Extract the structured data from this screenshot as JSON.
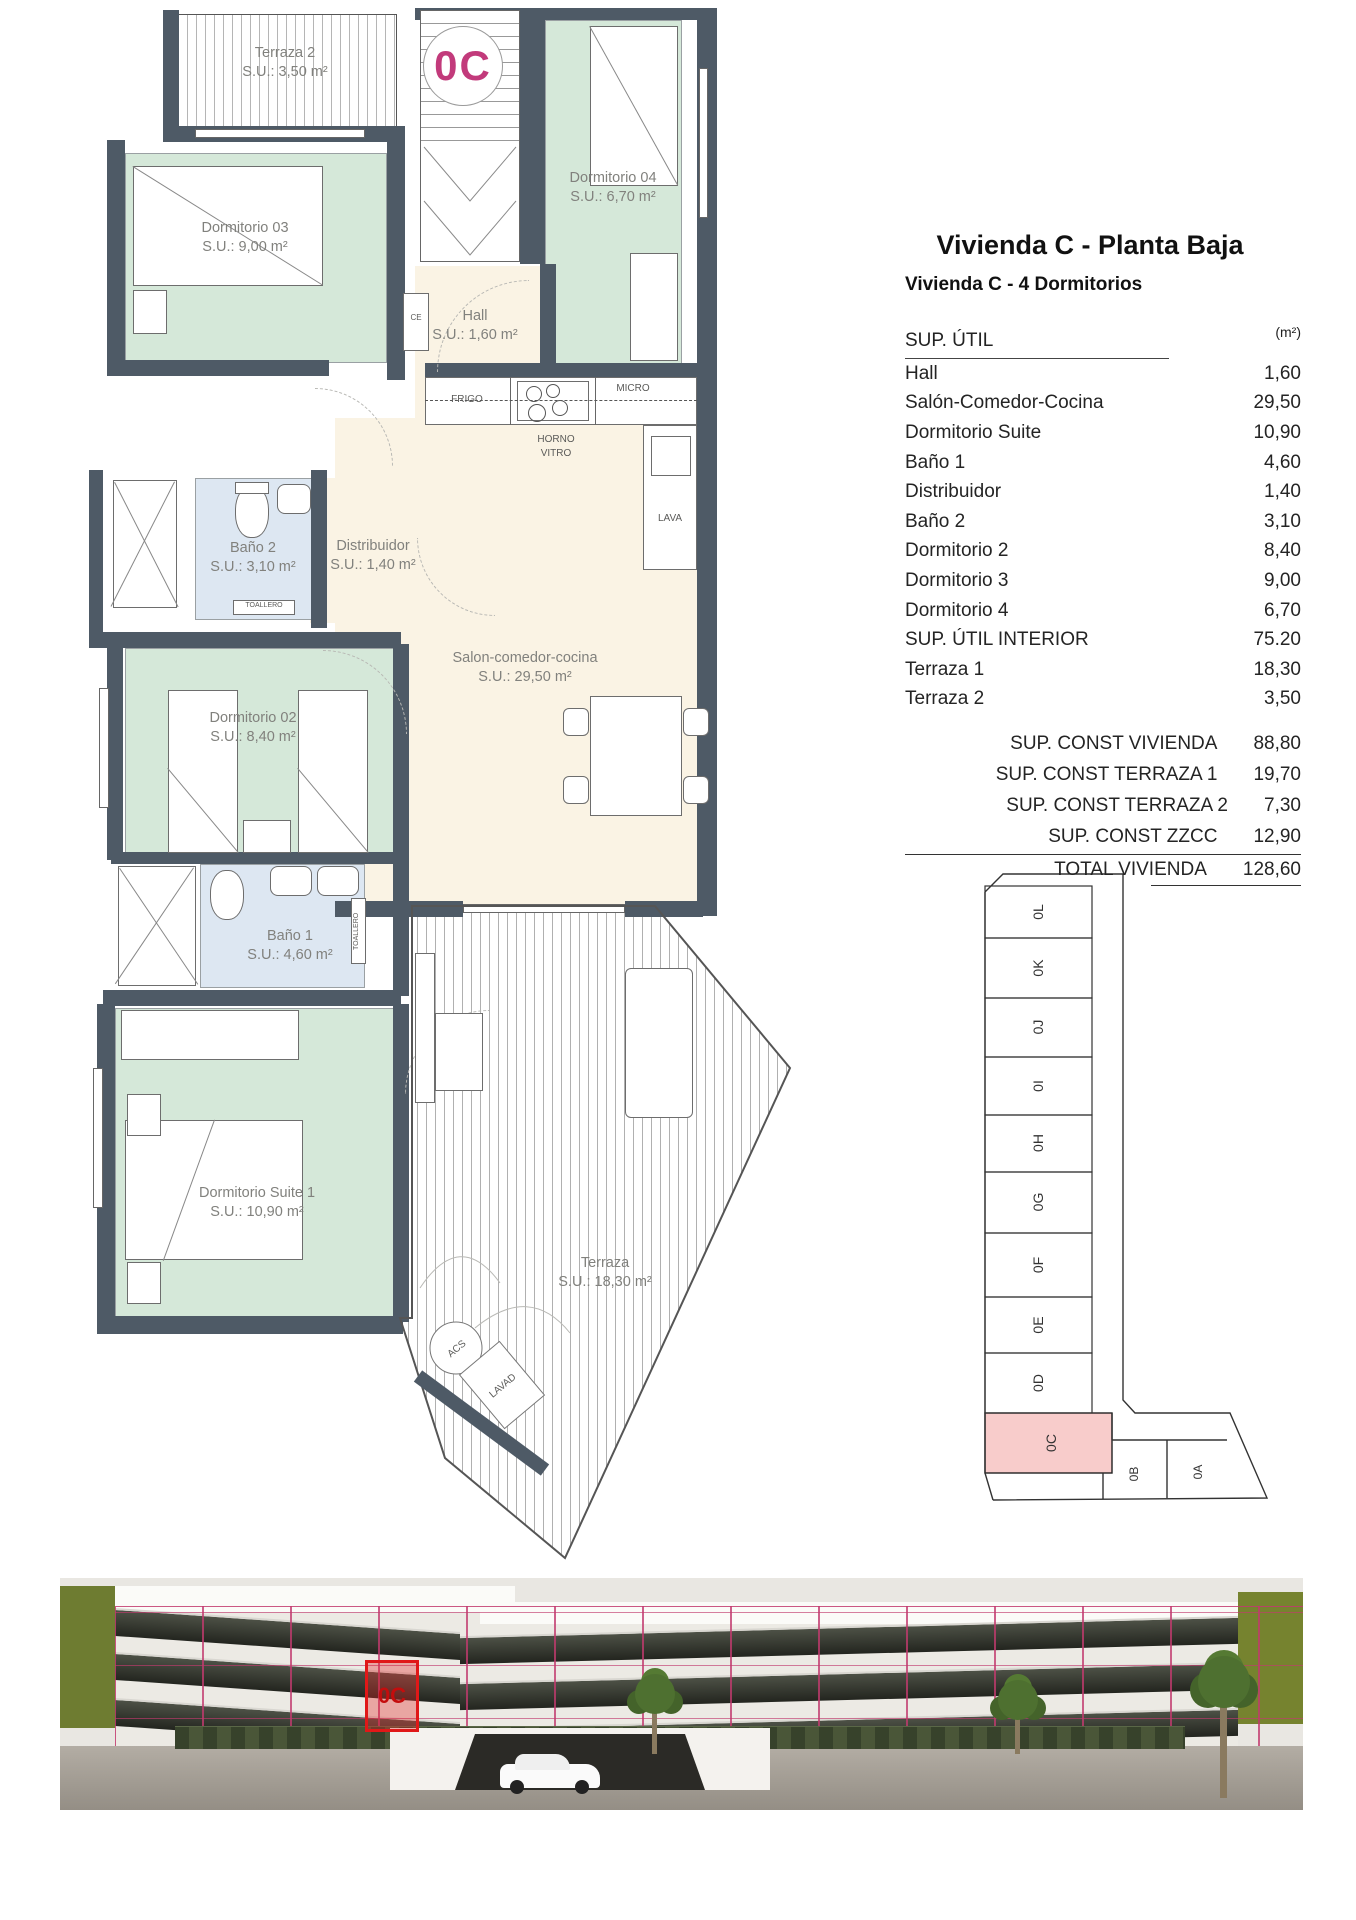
{
  "header": {
    "title": "Vivienda C - Planta Baja",
    "subtitle": "Vivienda C - 4 Dormitorios"
  },
  "area_table": {
    "title": "SUP. ÚTIL",
    "unit": "(m²)",
    "rows": [
      {
        "label": "Hall",
        "value": "1,60"
      },
      {
        "label": "Salón-Comedor-Cocina",
        "value": "29,50"
      },
      {
        "label": "Dormitorio Suite",
        "value": "10,90"
      },
      {
        "label": "Baño 1",
        "value": "4,60"
      },
      {
        "label": "Distribuidor",
        "value": "1,40"
      },
      {
        "label": "Baño 2",
        "value": "3,10"
      },
      {
        "label": "Dormitorio 2",
        "value": "8,40"
      },
      {
        "label": "Dormitorio 3",
        "value": "9,00"
      },
      {
        "label": "Dormitorio 4",
        "value": "6,70"
      },
      {
        "label": "SUP. ÚTIL INTERIOR",
        "value": "75.20"
      },
      {
        "label": "Terraza 1",
        "value": "18,30"
      },
      {
        "label": "Terraza 2",
        "value": "3,50"
      }
    ],
    "summary": [
      {
        "label": "SUP. CONST VIVIENDA",
        "value": "88,80"
      },
      {
        "label": "SUP. CONST TERRAZA 1",
        "value": "19,70"
      },
      {
        "label": "SUP. CONST TERRAZA 2",
        "value": "7,30"
      },
      {
        "label": "SUP. CONST ZZCC",
        "value": "12,90"
      }
    ],
    "total": {
      "label": "TOTAL VIVIENDA",
      "value": "128,60"
    }
  },
  "plan": {
    "badge": "0C",
    "rooms": {
      "terraza2": {
        "name": "Terraza 2",
        "area": "S.U.: 3,50 m²"
      },
      "dorm3": {
        "name": "Dormitorio 03",
        "area": "S.U.: 9,00 m²"
      },
      "dorm4": {
        "name": "Dormitorio 04",
        "area": "S.U.: 6,70 m²"
      },
      "hall": {
        "name": "Hall",
        "area": "S.U.: 1,60 m²"
      },
      "bano2": {
        "name": "Baño 2",
        "area": "S.U.: 3,10 m²"
      },
      "distribuidor": {
        "name": "Distribuidor",
        "area": "S.U.: 1,40 m²"
      },
      "salon": {
        "name": "Salon-comedor-cocina",
        "area": "S.U.: 29,50 m²"
      },
      "dorm2": {
        "name": "Dormitorio 02",
        "area": "S.U.: 8,40 m²"
      },
      "bano1": {
        "name": "Baño 1",
        "area": "S.U.: 4,60 m²"
      },
      "suite": {
        "name": "Dormitorio Suite 1",
        "area": "S.U.: 10,90 m²"
      },
      "terraza1": {
        "name": "Terraza",
        "area": "S.U.: 18,30 m²"
      }
    },
    "fixtures": {
      "frigo": "FRIGO",
      "micro": "MICRO",
      "horno_vitro": "HORNO VITRO",
      "lava": "LAVA",
      "ce": "CE",
      "toallero": "TOALLERO",
      "acs": "ACS",
      "lavad": "LAVAD"
    }
  },
  "key_plan": {
    "units": [
      "0L",
      "0K",
      "0J",
      "0I",
      "0H",
      "0G",
      "0F",
      "0E",
      "0D"
    ],
    "highlighted": "0C",
    "lower_units": [
      "0B",
      "0A"
    ]
  },
  "photo": {
    "highlight": "0C"
  },
  "colors": {
    "wall": "#4e5a66",
    "bedroom_fill": "#d5e8d9",
    "bath_fill": "#dde7f2",
    "living_fill": "#faf3e4",
    "keyplan_highlight": "#f8cccb",
    "badge_magenta": "#c23a7b",
    "overlay_magenta": "#c23a6e",
    "alert_red": "#e01818"
  }
}
